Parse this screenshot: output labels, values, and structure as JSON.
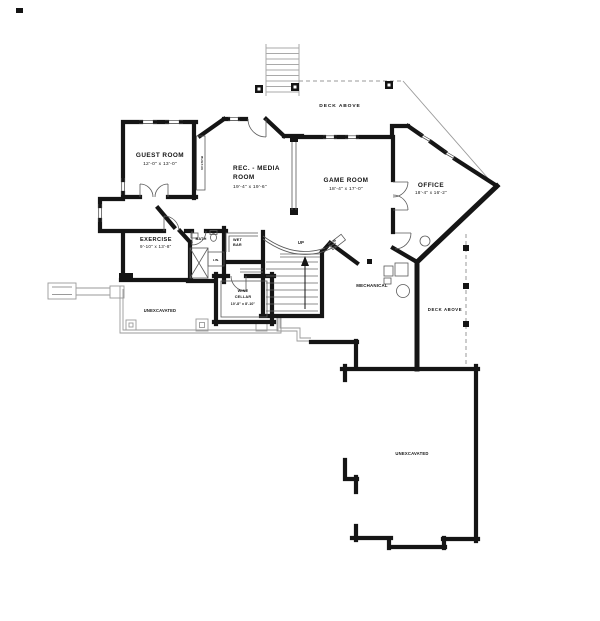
{
  "plan": {
    "title": "basement floor plan",
    "colors": {
      "wall": "#151515",
      "thin_line": "#555555",
      "light_line": "#9a9a9a",
      "background": "#ffffff"
    },
    "labels": {
      "guest_name": "GUEST ROOM",
      "guest_dims": "12'-0\" x 13'-0\"",
      "rec_1": "REC. - MEDIA",
      "rec_2": "ROOM",
      "rec_dims": "19'-4\" x 19'-6\"",
      "game_name": "GAME ROOM",
      "game_dims": "18'-4\" x 17'-0\"",
      "office_name": "OFFICE",
      "office_dims": "18'-4\" x 16'-2\"",
      "exercise_name": "EXERCISE",
      "exercise_dims": "9'-10\" x 13'-8\"",
      "bath": "BATH",
      "wet_1": "WET",
      "wet_2": "BAR",
      "lin": "LIN.",
      "up": "UP",
      "built_in_guest": "BUILT-IN",
      "built_in_game": "BUILT-IN",
      "mechanical": "MECHANICAL",
      "wine_1": "WINE",
      "wine_2": "CELLAR",
      "wine_dims": "10'-8\" x 8'-10\"",
      "unexcavated_left": "UNEXCAVATED",
      "unexcavated_main": "UNEXCAVATED",
      "deck_top": "DECK ABOVE",
      "deck_right": "DECK ABOVE"
    }
  }
}
